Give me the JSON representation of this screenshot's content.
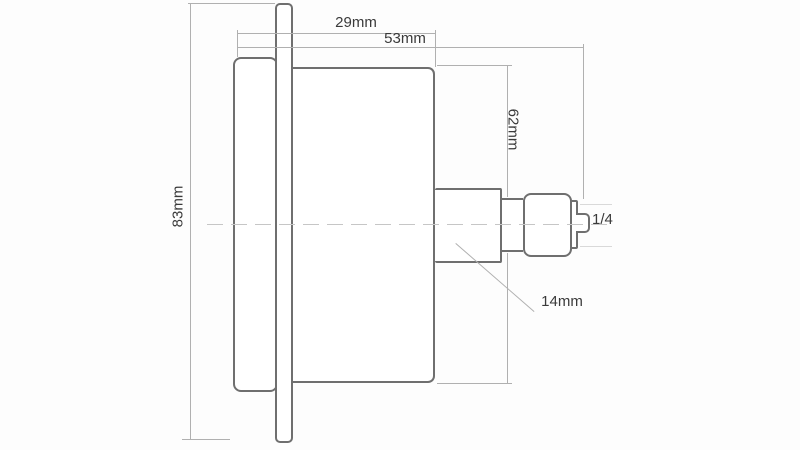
{
  "drawing": {
    "description_labels": {
      "dim_29": "29mm",
      "dim_53": "53mm",
      "dim_62": "62mm",
      "dim_83": "83mm",
      "dim_14": "14mm",
      "thread": "1/4"
    },
    "colors": {
      "background": "#fdfdfd",
      "outline": "#6f6f6f",
      "dimension": "#b0b0b0",
      "centerline": "#c6c6c6",
      "text": "#3a3a3a"
    }
  }
}
